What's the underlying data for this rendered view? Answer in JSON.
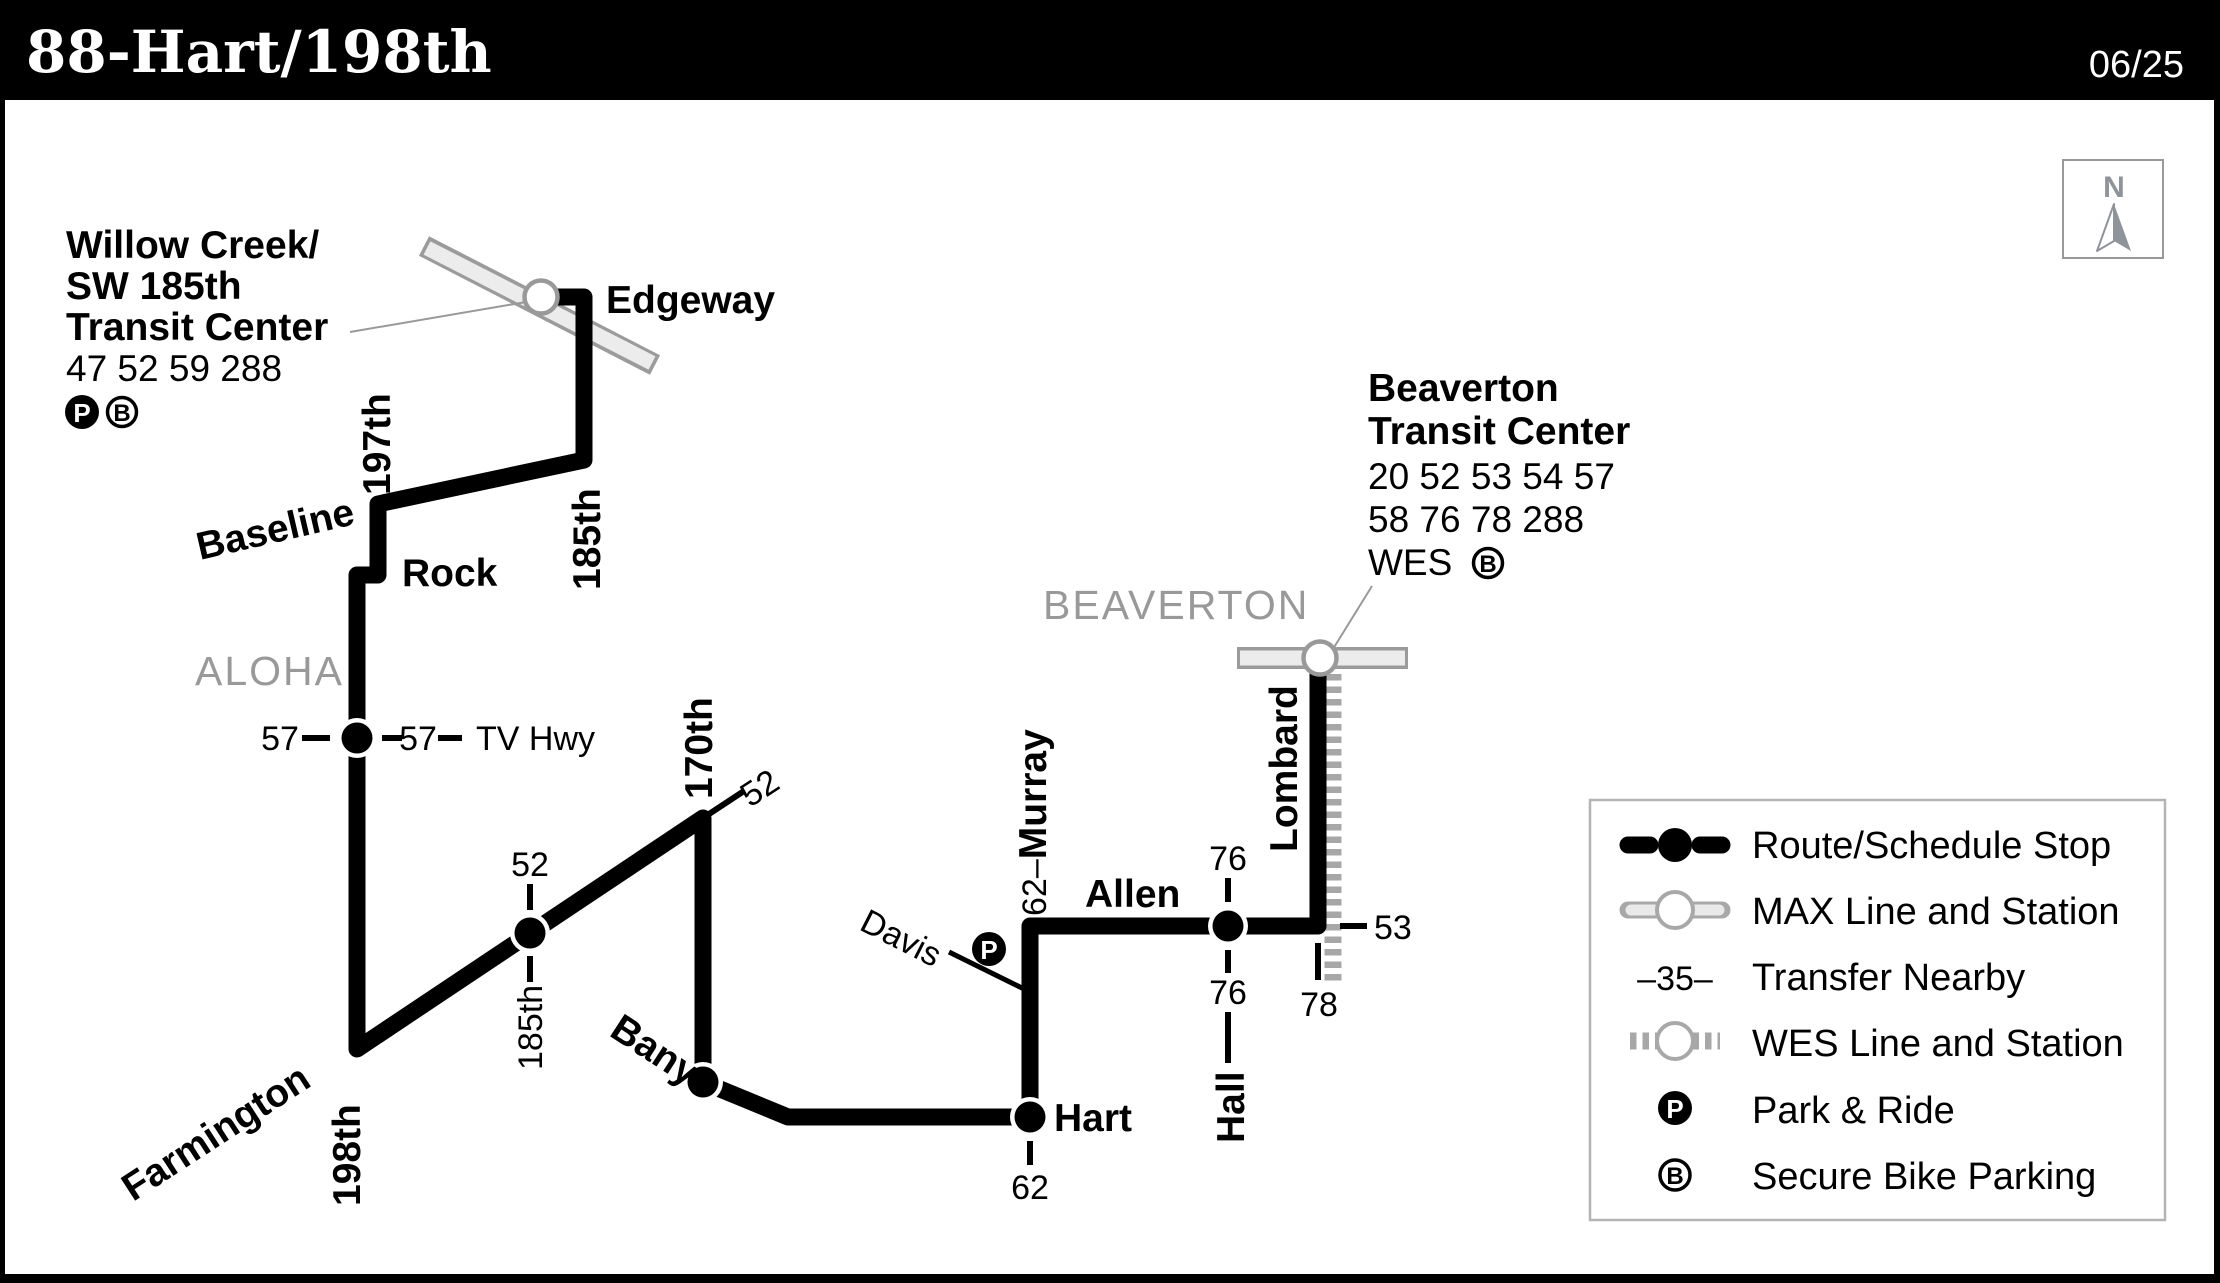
{
  "header": {
    "title": "88-Hart/198th",
    "date": "06/25"
  },
  "map": {
    "willow_creek": {
      "name_line1": "Willow Creek/",
      "name_line2": "SW 185th",
      "name_line3": "Transit Center",
      "routes": "47 52 59 288"
    },
    "beaverton_tc": {
      "name_line1": "Beaverton",
      "name_line2": "Transit Center",
      "routes_line1": "20 52 53 54 57",
      "routes_line2": "58 76 78 288",
      "wes": "WES"
    },
    "areas": {
      "aloha": "ALOHA",
      "beaverton": "BEAVERTON"
    },
    "streets": {
      "edgeway": "Edgeway",
      "st197": "197th",
      "baseline": "Baseline",
      "rock": "Rock",
      "st185_upper": "185th",
      "tv_hwy": "TV Hwy",
      "farmington": "Farmington",
      "st198": "198th",
      "st185_lower": "185th",
      "st170": "170th",
      "bany": "Bany",
      "hart": "Hart",
      "davis": "Davis",
      "murray": "Murray",
      "allen": "Allen",
      "hall": "Hall",
      "lombard": "Lombard"
    },
    "transfers": {
      "tv_hwy_left": "57",
      "tv_hwy_right": "57",
      "st185_stop": "52",
      "st170_corner": "52",
      "hart_below": "62",
      "murray_prefix": "62–",
      "hall_above": "76",
      "hall_below": "76",
      "lombard_right": "53",
      "lombard_below": "78"
    },
    "badges": {
      "park_and_ride": "P",
      "bike_parking": "B"
    },
    "compass": {
      "north": "N"
    }
  },
  "legend": {
    "items": [
      {
        "label": "Route/Schedule Stop"
      },
      {
        "label": "MAX Line and Station"
      },
      {
        "label": "Transfer Nearby",
        "icon_text": "–35–"
      },
      {
        "label": "WES Line and Station"
      },
      {
        "label": "Park & Ride",
        "icon_text": "P"
      },
      {
        "label": "Secure Bike Parking",
        "icon_text": "B"
      }
    ]
  }
}
